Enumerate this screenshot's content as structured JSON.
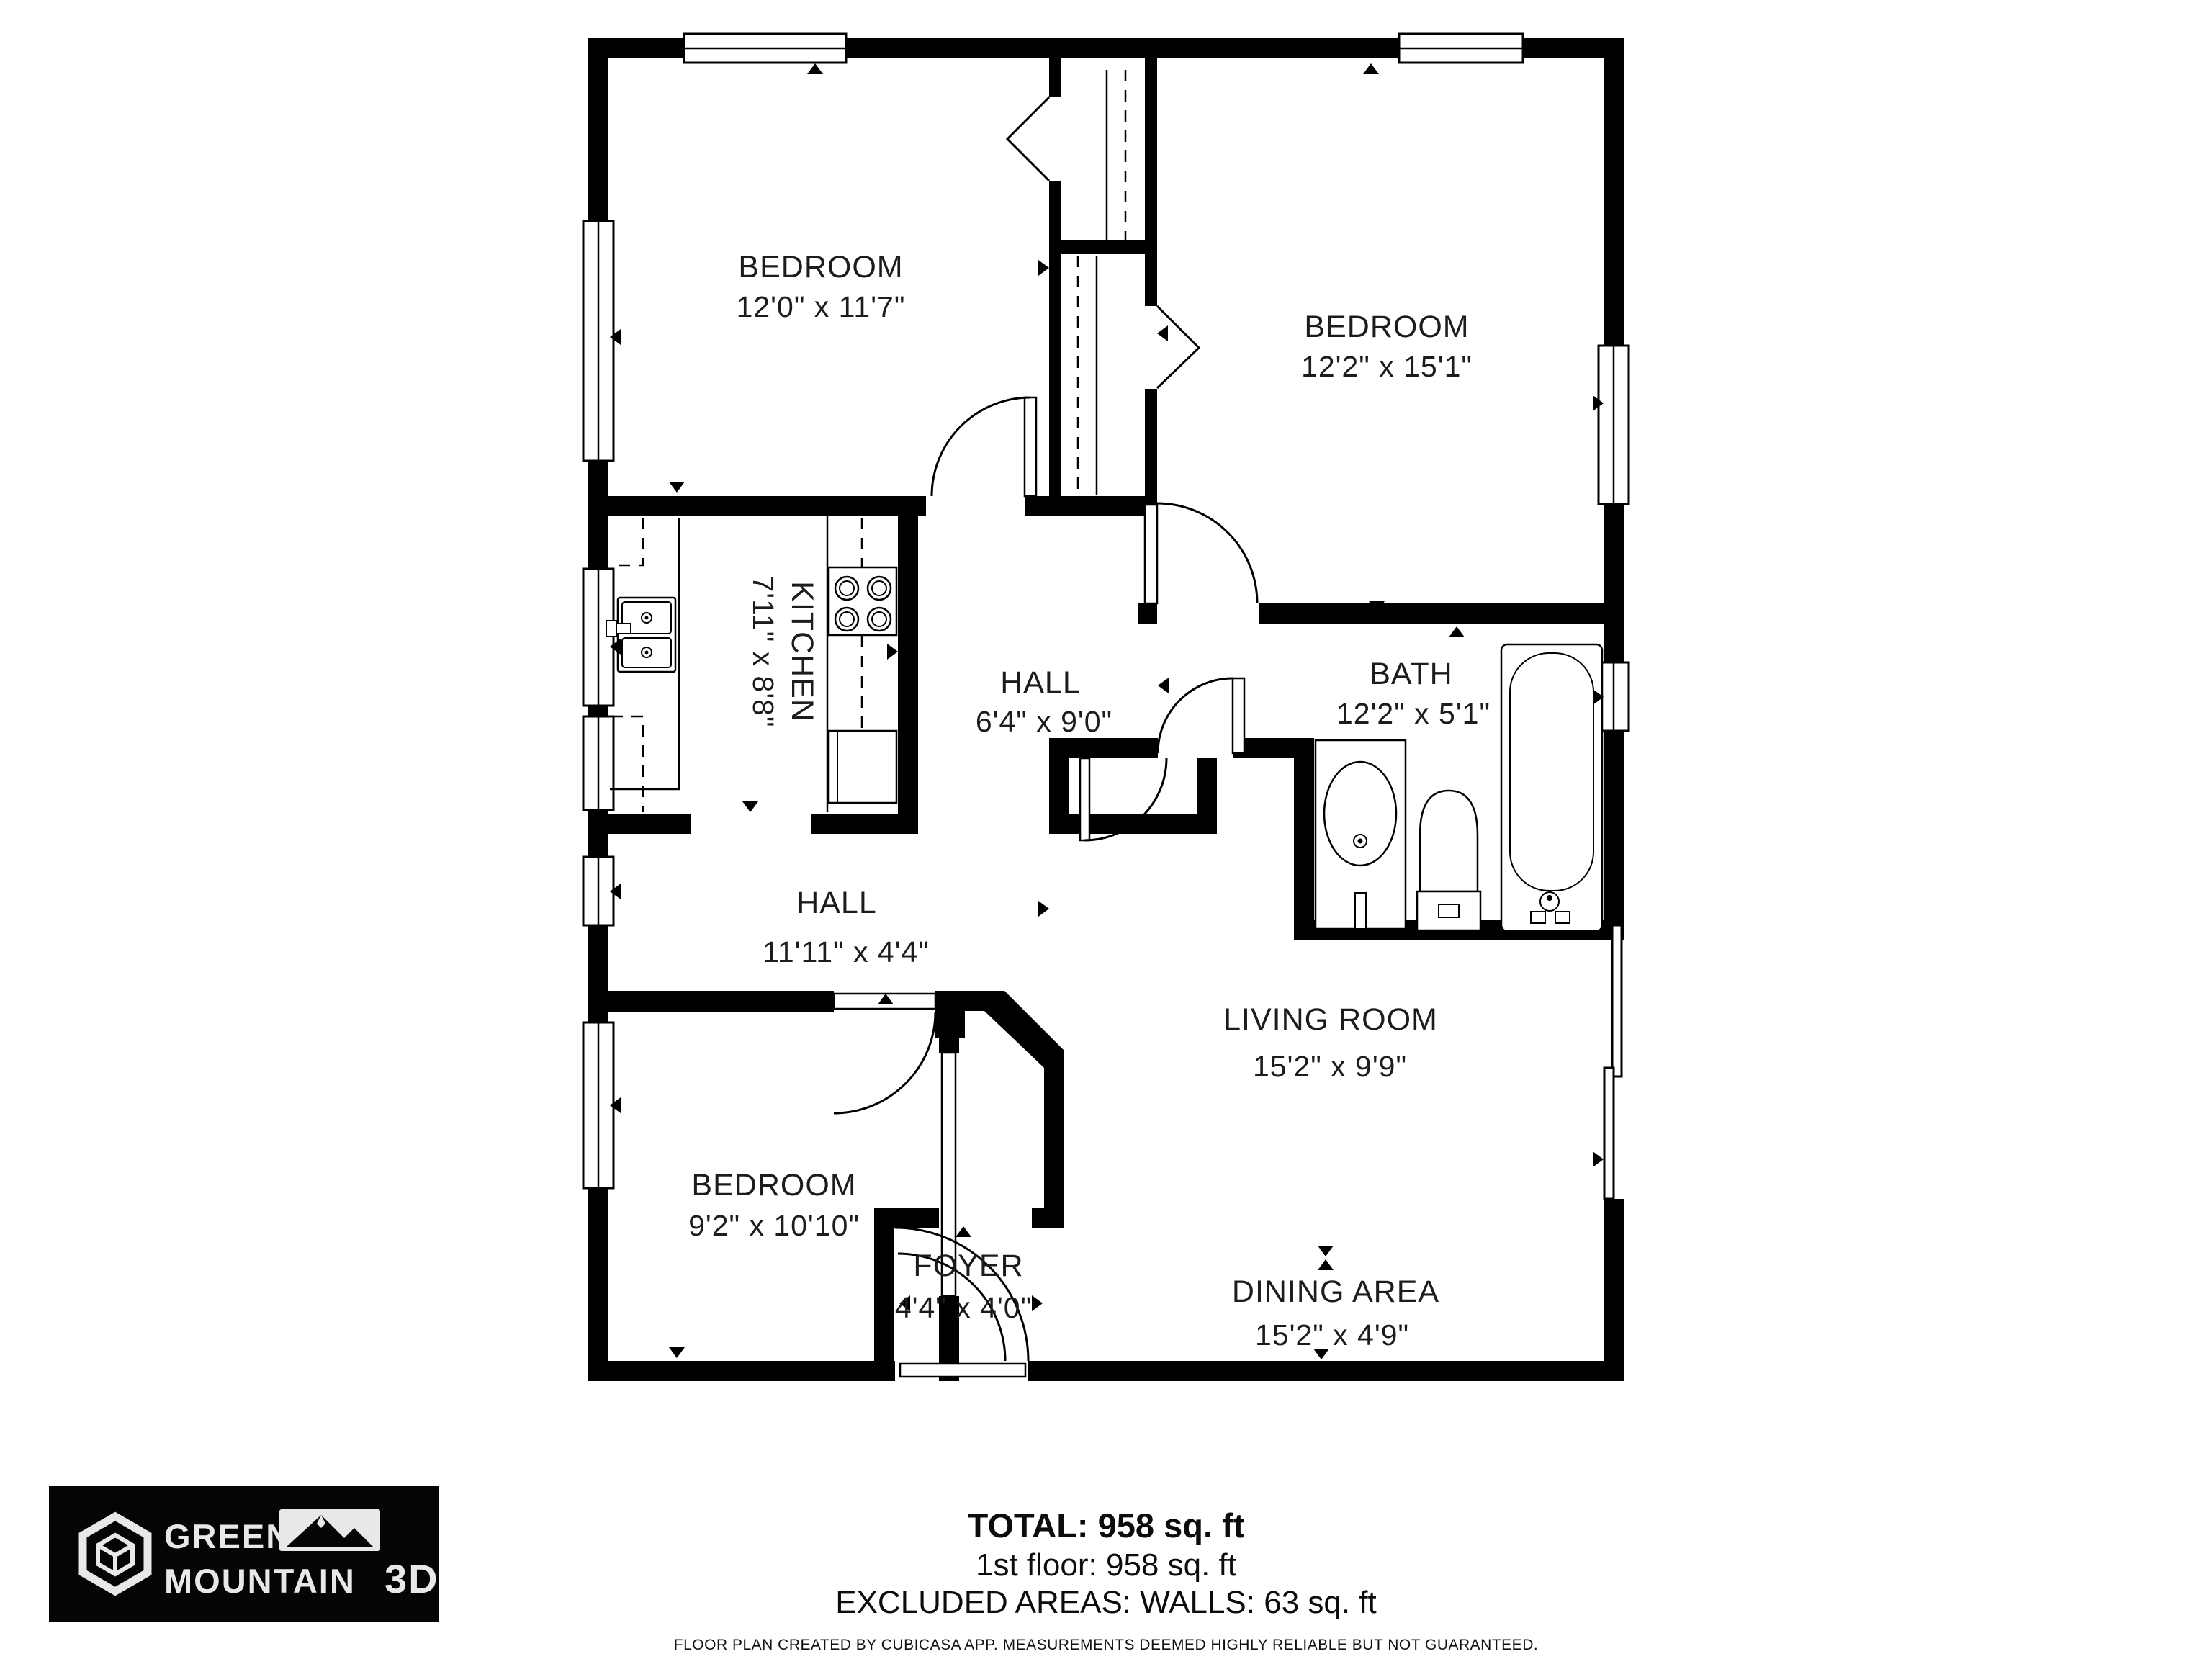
{
  "floor_plan": {
    "rooms": [
      {
        "id": "bedroom-top-left",
        "name": "BEDROOM",
        "dims": "12'0\" x 11'7\""
      },
      {
        "id": "bedroom-top-right",
        "name": "BEDROOM",
        "dims": "12'2\" x 15'1\""
      },
      {
        "id": "kitchen",
        "name": "KITCHEN",
        "dims": "7'11\" x 8'8\""
      },
      {
        "id": "hall-upper",
        "name": "HALL",
        "dims": "6'4\" x 9'0\""
      },
      {
        "id": "bath",
        "name": "BATH",
        "dims": "12'2\" x 5'1\""
      },
      {
        "id": "hall-lower",
        "name": "HALL",
        "dims": "11'11\" x 4'4\""
      },
      {
        "id": "bedroom-lower-left",
        "name": "BEDROOM",
        "dims": "9'2\" x 10'10\""
      },
      {
        "id": "living-room",
        "name": "LIVING ROOM",
        "dims": "15'2\" x 9'9\""
      },
      {
        "id": "dining-area",
        "name": "DINING AREA",
        "dims": "15'2\" x 4'9\""
      },
      {
        "id": "foyer",
        "name": "FOYER",
        "dims": "4'4\" x 4'0\""
      }
    ]
  },
  "summary": {
    "total": "TOTAL: 958 sq. ft",
    "floor1": "1st floor: 958 sq. ft",
    "excluded": "EXCLUDED AREAS: WALLS: 63 sq. ft"
  },
  "disclaimer": "FLOOR PLAN CREATED BY CUBICASA APP. MEASUREMENTS DEEMED HIGHLY RELIABLE BUT NOT GUARANTEED.",
  "logo": {
    "line1": "GREEN",
    "line2": "MOUNTAIN",
    "suffix": "3D"
  },
  "colors": {
    "wall": "#000000",
    "background": "#ffffff",
    "text": "#1c1c1e",
    "logo_bg": "#050505",
    "logo_text": "#e8e8e6"
  }
}
